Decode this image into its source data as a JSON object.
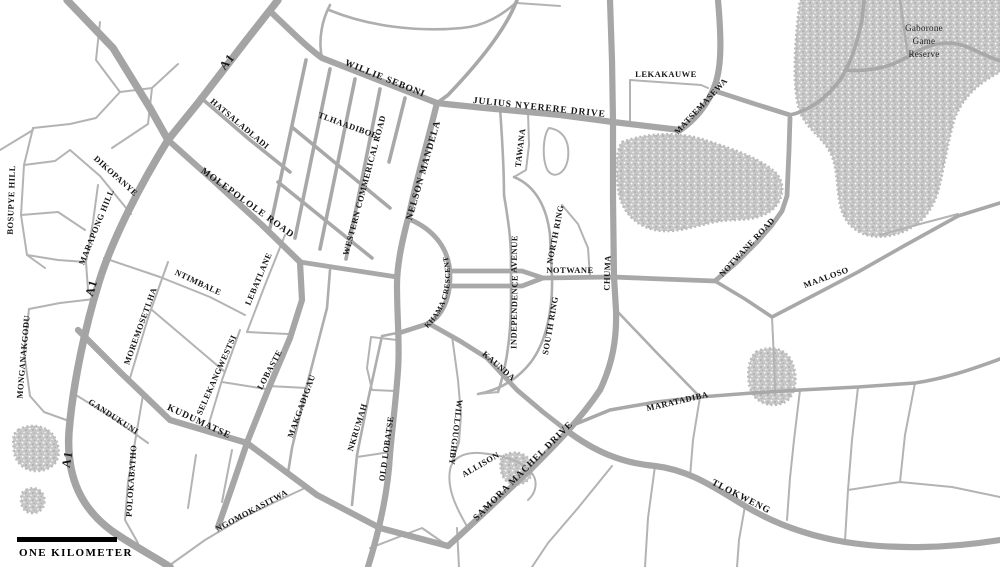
{
  "map": {
    "scale_bar": {
      "label": "ONE KILOMETER"
    },
    "reserve": {
      "line1": "Gaborone",
      "line2": "Game",
      "line3": "Reserve"
    },
    "labels": {
      "a1_top": "A1",
      "a1_mid": "A1",
      "a1_bottom": "A1",
      "willie_seboni": "WILLIE SEBONI",
      "julius_nyerere_drive": "JULIUS NYERERE DRIVE",
      "lekakauwe": "LEKAKAUWE",
      "matsemasewa": "MATSEMASEWA",
      "hatsaladladi": "HATSALADLADI",
      "tlhaadiboe": "TLHAADIBOE",
      "western_commerical_road": "WESTERN COMMERICAL ROAD",
      "nelson_mandela": "NELSON MANDELA",
      "tawana": "TAWANA",
      "north_ring": "NORTH RING",
      "south_ring": "SOUTH RING",
      "notwane": "NOTWANE",
      "chuma": "CHUMA",
      "notwane_road": "NOTWANE ROAD",
      "maaloso": "MAALOSO",
      "independence": "INDEPENDENCE",
      "avenue": "AVENUE",
      "khama_crescent": "KHAMA CRESCENT",
      "kaunda": "KAUNDA",
      "willoughby": "WILLOUGHBY",
      "allison": "ALLISON",
      "samora_machel_drive": "SAMORA MACHEL DRIVE",
      "old_lobatse": "OLD LOBATSE",
      "tlokweng": "TLOKWENG",
      "maratadiba": "MARATADIBA",
      "kudumatse": "KUDUMATSE",
      "gandukuni": "GANDUKUNI",
      "monganakgodu": "MONGANAKGODU",
      "moremosetlha": "MOREMOSETLHA",
      "ntimbale": "NTIMBALE",
      "lebatlane": "LEBATLANE",
      "selekangwestsi": "SELEKANGWESTSI",
      "lobaste": "LOBASTE",
      "makgadigau": "MAKGADIGAU",
      "nkrumah": "NKRUMAH",
      "polokabatho": "POLOKABATHO",
      "ngomokasitwa": "NGOMOKASITWA",
      "dikopanye": "DIKOPANYE",
      "bosupye_hill": "BOSUPYE HILL",
      "marapong_hill": "MARAPONG HILL",
      "molepolole_road": "MOLEPOLOLE ROAD"
    },
    "colors": {
      "background": "#ffffff",
      "road": "#a8a8a8",
      "minor_road": "#b3b3b3",
      "vegetation": "#c8c8c8",
      "label": "#161616",
      "scale_bar": "#000000"
    }
  }
}
